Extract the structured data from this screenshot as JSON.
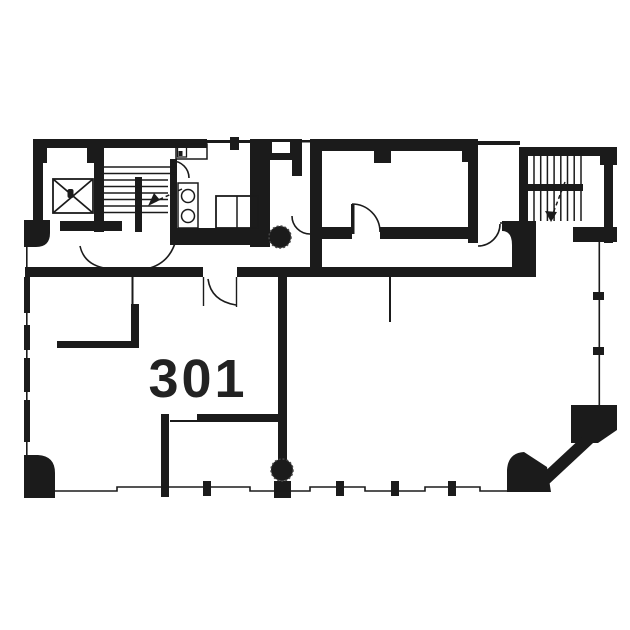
{
  "plan": {
    "room_label": "301",
    "colors": {
      "wall": "#1b1b1b",
      "background": "#ffffff",
      "label": "#222222"
    },
    "features": [
      "elevator",
      "staircase-west",
      "staircase-east",
      "restroom-vanity",
      "storage-cabinet",
      "structural-column-north",
      "structural-column-south",
      "entrance-door",
      "window-wall-west",
      "window-wall-south",
      "window-wall-east",
      "chamfered-corner"
    ]
  }
}
